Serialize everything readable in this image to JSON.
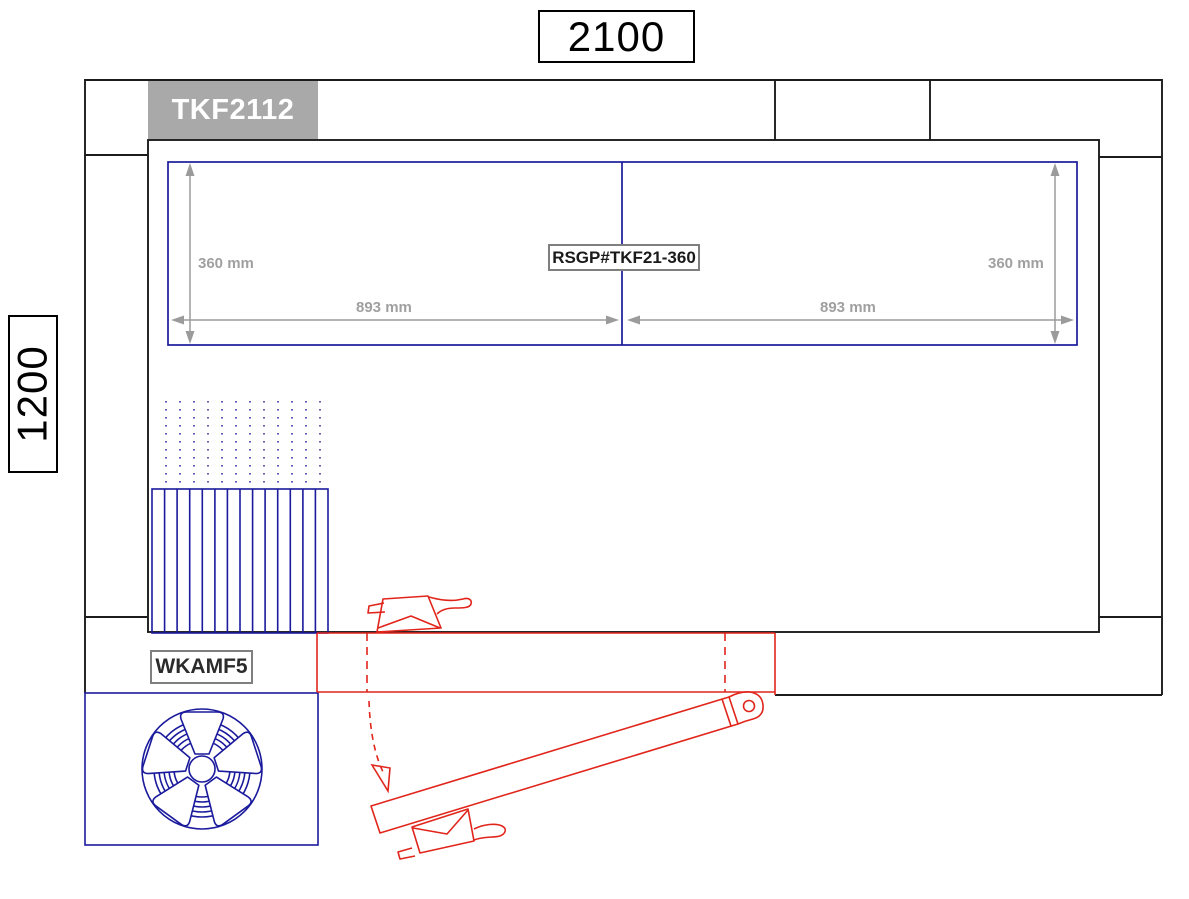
{
  "drawing": {
    "overall_width_label": "2100",
    "overall_depth_label": "1200",
    "hood_model_label": "TKF2112",
    "filter_part_label": "RSGP#TKF21-360",
    "fan_module_label": "WKAMF5",
    "dims": {
      "left_vertical": "360 mm",
      "right_vertical": "360 mm",
      "left_horizontal": "893 mm",
      "right_horizontal": "893 mm"
    }
  },
  "colors": {
    "frame_black": "#1c1c1c",
    "component_blue": "#1a1a9c",
    "mechanism_red": "#e1251b",
    "dimension_gray": "#a0a0a0",
    "model_box_fill": "#a9a9a9",
    "model_box_text": "#ffffff",
    "part_box_border": "#7f7f7f"
  }
}
